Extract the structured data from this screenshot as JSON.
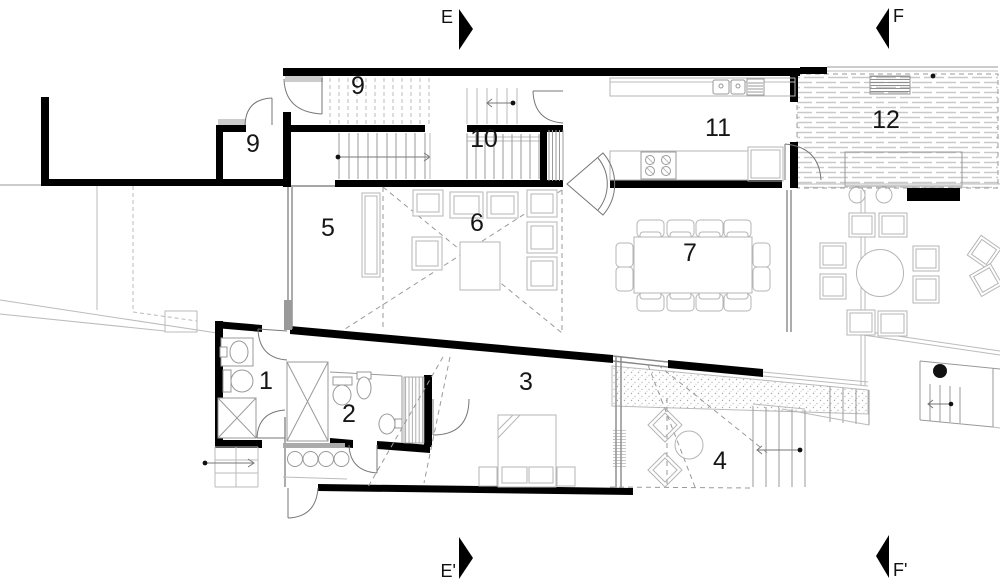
{
  "meta": {
    "title": "Residential floor plan",
    "drawing_type": "architectural plan with section markers",
    "width_px": 1000,
    "height_px": 587
  },
  "colors": {
    "background": "#ffffff",
    "walls": "#000000",
    "thin_lines": "#999999",
    "furniture_lines": "#b5b5b5",
    "dashed_lines": "#9a9a9a",
    "labels": "#161616"
  },
  "section_markers": [
    {
      "label": "E",
      "position": "top-center",
      "direction": "right"
    },
    {
      "label": "F",
      "position": "top-right",
      "direction": "left"
    },
    {
      "label": "E'",
      "position": "bottom-center",
      "direction": "right"
    },
    {
      "label": "F'",
      "position": "bottom-right",
      "direction": "left"
    }
  ],
  "room_labels": [
    {
      "number": "9"
    },
    {
      "number": "9"
    },
    {
      "number": "10"
    },
    {
      "number": "11"
    },
    {
      "number": "12"
    },
    {
      "number": "5"
    },
    {
      "number": "6"
    },
    {
      "number": "7"
    },
    {
      "number": "1"
    },
    {
      "number": "2"
    },
    {
      "number": "3"
    },
    {
      "number": "4"
    }
  ]
}
